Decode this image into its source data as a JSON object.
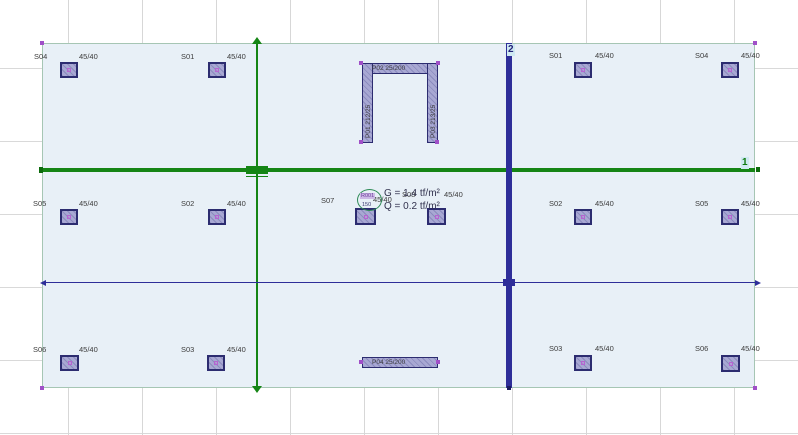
{
  "axes": {
    "axis_1": {
      "label": "1"
    },
    "axis_2": {
      "label": "2"
    }
  },
  "columns": [
    {
      "name": "S04",
      "size": "45/40"
    },
    {
      "name": "S01",
      "size": "45/40"
    },
    {
      "name": "S01",
      "size": "45/40"
    },
    {
      "name": "S04",
      "size": "45/40"
    },
    {
      "name": "S05",
      "size": "45/40"
    },
    {
      "name": "S02",
      "size": "45/40"
    },
    {
      "name": "S07",
      "size": "45/40"
    },
    {
      "name": "S08",
      "size": "45/40"
    },
    {
      "name": "S02",
      "size": "45/40"
    },
    {
      "name": "S05",
      "size": "45/40"
    },
    {
      "name": "S06",
      "size": "45/40"
    },
    {
      "name": "S03",
      "size": "45/40"
    },
    {
      "name": "S03",
      "size": "45/40"
    },
    {
      "name": "S06",
      "size": "45/40"
    }
  ],
  "walls": [
    {
      "label": "P02  25/200"
    },
    {
      "label": "P01  212/25"
    },
    {
      "label": "P03  213/25"
    },
    {
      "label": "P04  25/200"
    }
  ],
  "load_annotation": {
    "region_id": "R001",
    "region_value": "150",
    "dead_load": "G = 1.4  tf/m²",
    "live_load": "Q = 0.2  tf/m²"
  },
  "colors": {
    "slab_fill": "#e8f0f7",
    "slab_edge": "#a6c6b4",
    "axis_green": "#158515",
    "axis_blue": "#2e2e99",
    "element_purple": "#a8a8d3",
    "element_border": "#2c2c70",
    "handle_purple": "#a050c8"
  }
}
